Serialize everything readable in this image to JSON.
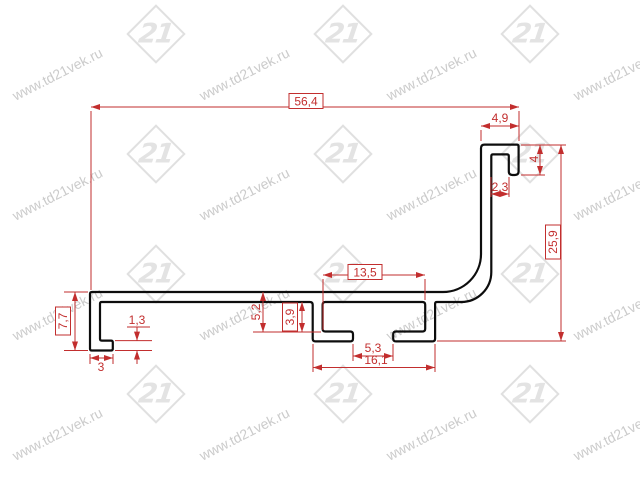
{
  "watermark": {
    "text": "www.td21vek.ru",
    "logo_text": "21"
  },
  "drawing": {
    "type": "profile-cross-section",
    "colors": {
      "dimension_red": "#c22e2e",
      "profile_black": "#0d0d0d",
      "watermark_gray": "#e0e0e0"
    },
    "dimensions": {
      "overall_width": {
        "label": "56,4",
        "boxed": true
      },
      "hook_width": {
        "label": "4,9",
        "boxed": false
      },
      "hook_lip_height": {
        "label": "4",
        "boxed": false
      },
      "hook_slot_opening": {
        "label": "2,3",
        "boxed": false
      },
      "overall_height": {
        "label": "25,9",
        "boxed": true
      },
      "channel_inner_width": {
        "label": "13,5",
        "boxed": true
      },
      "channel_depth_total": {
        "label": "5,2",
        "boxed": false
      },
      "channel_depth_inner": {
        "label": "3,9",
        "boxed": true
      },
      "channel_opening": {
        "label": "5,3",
        "boxed": false
      },
      "channel_outer_width": {
        "label": "16,1",
        "boxed": false
      },
      "left_end_height": {
        "label": "7,7",
        "boxed": true
      },
      "left_foot_thickness": {
        "label": "1,3",
        "boxed": false
      },
      "left_foot_width": {
        "label": "3",
        "boxed": false
      }
    }
  }
}
